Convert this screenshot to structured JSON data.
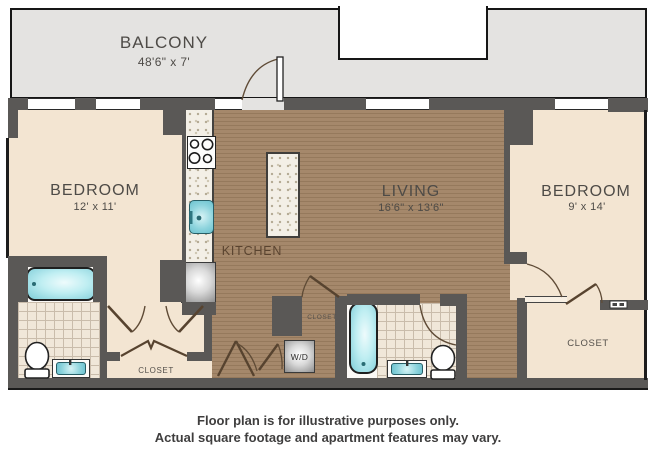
{
  "plan": {
    "balcony": {
      "label": "BALCONY",
      "dims": "48'6\" x 7'"
    },
    "bedroom_left": {
      "label": "BEDROOM",
      "dims": "12' x 11'"
    },
    "living": {
      "label": "LIVING",
      "dims": "16'6\" x 13'6\""
    },
    "bedroom_right": {
      "label": "BEDROOM",
      "dims": "9' x 14'"
    },
    "kitchen": {
      "label": "KITCHEN"
    },
    "closet_hall": {
      "label": "CLOSET"
    },
    "closet_mid": {
      "label": "CLOSET"
    },
    "closet_right": {
      "label": "CLOSET"
    },
    "washer_dryer": {
      "label": "W/D"
    }
  },
  "disclaimer": {
    "line1": "Floor plan is for illustrative purposes only.",
    "line2": "Actual square footage and apartment features may vary."
  },
  "colors": {
    "wall": "#5a5856",
    "wood_floor": "#a5886b",
    "room_cream": "#f3e5d2",
    "balcony_gray": "#e4e3e1",
    "fixture_teal": "#7fcdd8",
    "tile": "#f0e7d9"
  }
}
